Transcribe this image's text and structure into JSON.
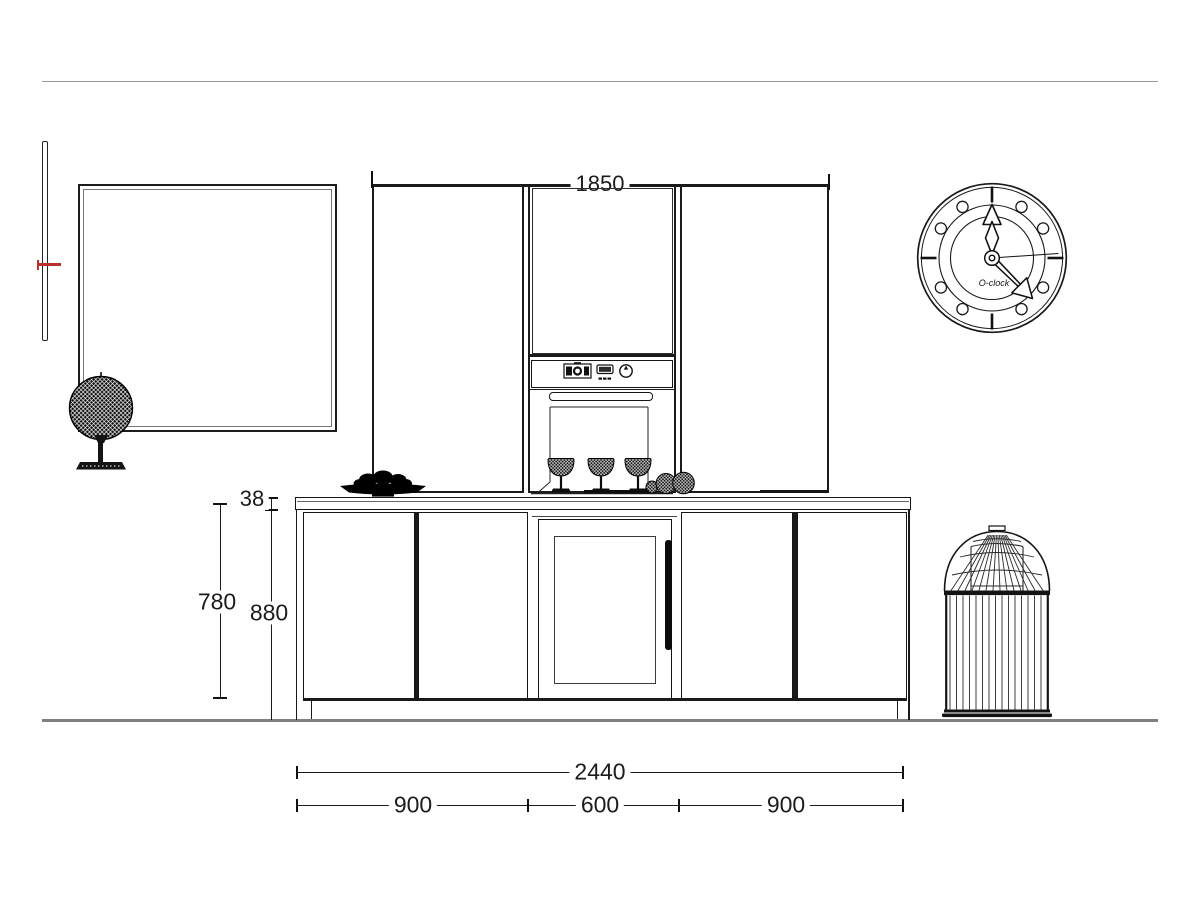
{
  "dimensions": {
    "upper_run_width": "1850",
    "worktop_thickness": "38",
    "base_door_height": "780",
    "worktop_height": "880",
    "base_run_total_width": "2440",
    "left_section_width": "900",
    "middle_section_width": "600",
    "right_section_width": "900"
  },
  "clock": {
    "brand_label": "O-clock"
  },
  "icons": {
    "oven_display_icon": "oven program display",
    "oven_timer_icon": "digital timer display",
    "oven_knob_icon": "control knob"
  },
  "colors": {
    "line": "#1a1a1a",
    "ceiling_line": "#999999",
    "floor_line": "#808080",
    "accent_red": "#b5322c",
    "background": "#ffffff"
  }
}
